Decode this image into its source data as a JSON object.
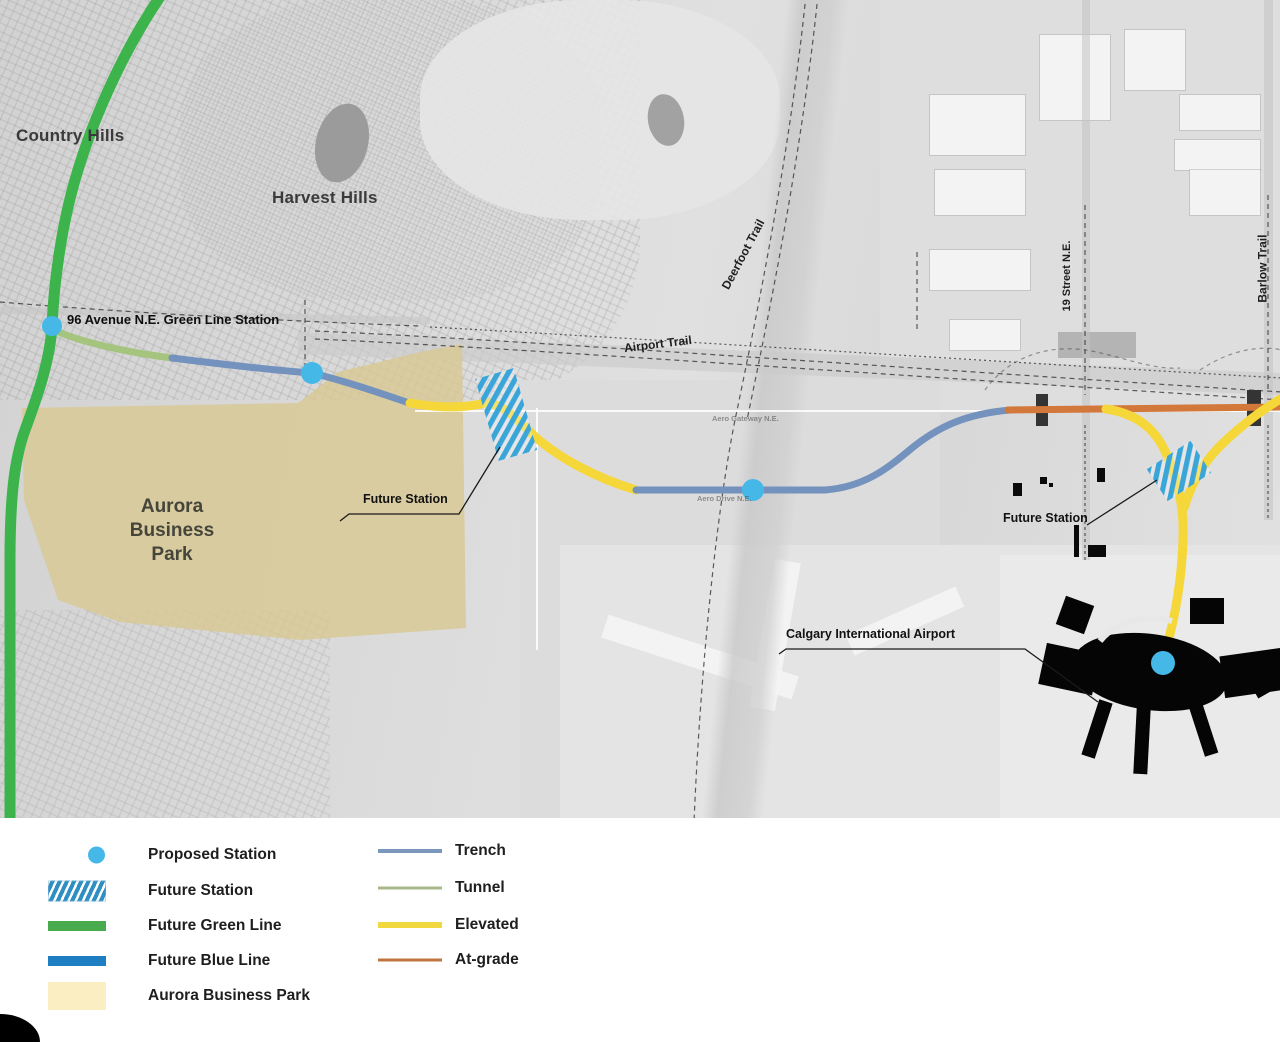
{
  "map": {
    "labels": {
      "country_hills": "Country Hills",
      "harvest_hills": "Harvest Hills",
      "green_line_station_96ave": "96 Avenue N.E. Green Line Station",
      "airport_trail": "Airport Trail",
      "deerfoot_trail": "Deerfoot Trail",
      "street_19": "19 Street N.E.",
      "barlow_trail": "Barlow Trail",
      "aurora_business_park": "Aurora\nBusiness\nPark",
      "future_station_west": "Future Station",
      "future_station_east": "Future Station",
      "calgary_airport": "Calgary International Airport",
      "road_aero_gateway": "Aero Gateway N.E.",
      "road_aero_drive": "Aero Drive N.E."
    },
    "colors": {
      "green_line": "#3cb34b",
      "tunnel": "#a5c47d",
      "trench": "#7492be",
      "elevated": "#f5d73a",
      "at_grade": "#d2783a",
      "station_dot": "#45b8e8",
      "station_hatch": "#3aa5d9",
      "business_park_fill": "#d8c892",
      "leader_line": "#1a1a1a"
    }
  },
  "legend": {
    "left": [
      {
        "label": "Proposed Station",
        "type": "dot"
      },
      {
        "label": "Future Station",
        "type": "hatch"
      },
      {
        "label": "Future Green Line",
        "type": "bar",
        "color": "#48ac4e"
      },
      {
        "label": "Future Blue Line",
        "type": "bar",
        "color": "#1d7fc2"
      },
      {
        "label": "Aurora Business Park",
        "type": "rect",
        "color": "#fbeec3"
      }
    ],
    "right": [
      {
        "label": "Trench",
        "color": "#7b97bb",
        "thickness": "4px"
      },
      {
        "label": "Tunnel",
        "color": "#a9b88c",
        "thickness": "3px"
      },
      {
        "label": "Elevated",
        "color": "#efd93f",
        "thickness": "6px"
      },
      {
        "label": "At-grade",
        "color": "#bf7440",
        "thickness": "3px"
      }
    ]
  }
}
